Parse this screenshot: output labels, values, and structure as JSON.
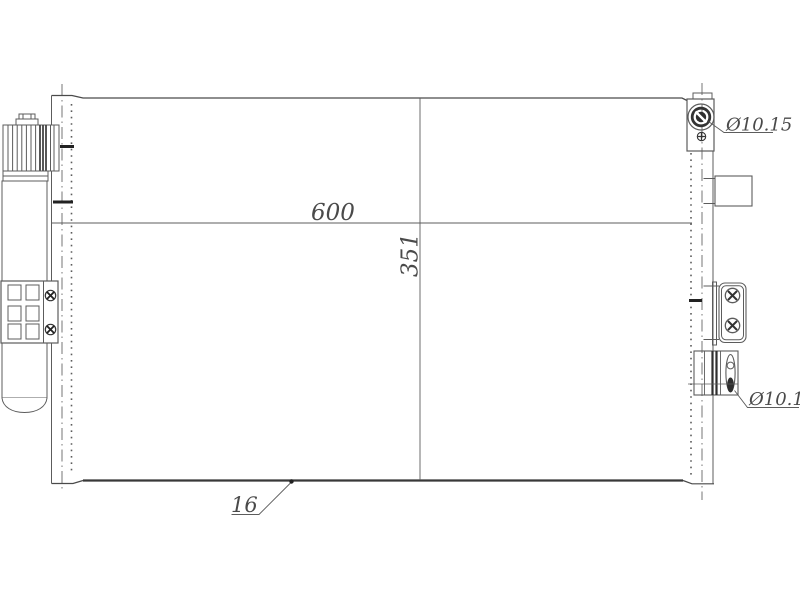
{
  "drawing": {
    "title": "condenser-technical-drawing",
    "labels": {
      "core_width": "600",
      "core_height": "351",
      "core_depth": "16",
      "top_port_diameter": "Ø10.15",
      "bottom_port_diameter": "Ø10.15"
    },
    "colors": {
      "line": "#5c5c5c",
      "dark_line": "#303030",
      "text": "#4a4a4a",
      "background": "#ffffff"
    }
  }
}
